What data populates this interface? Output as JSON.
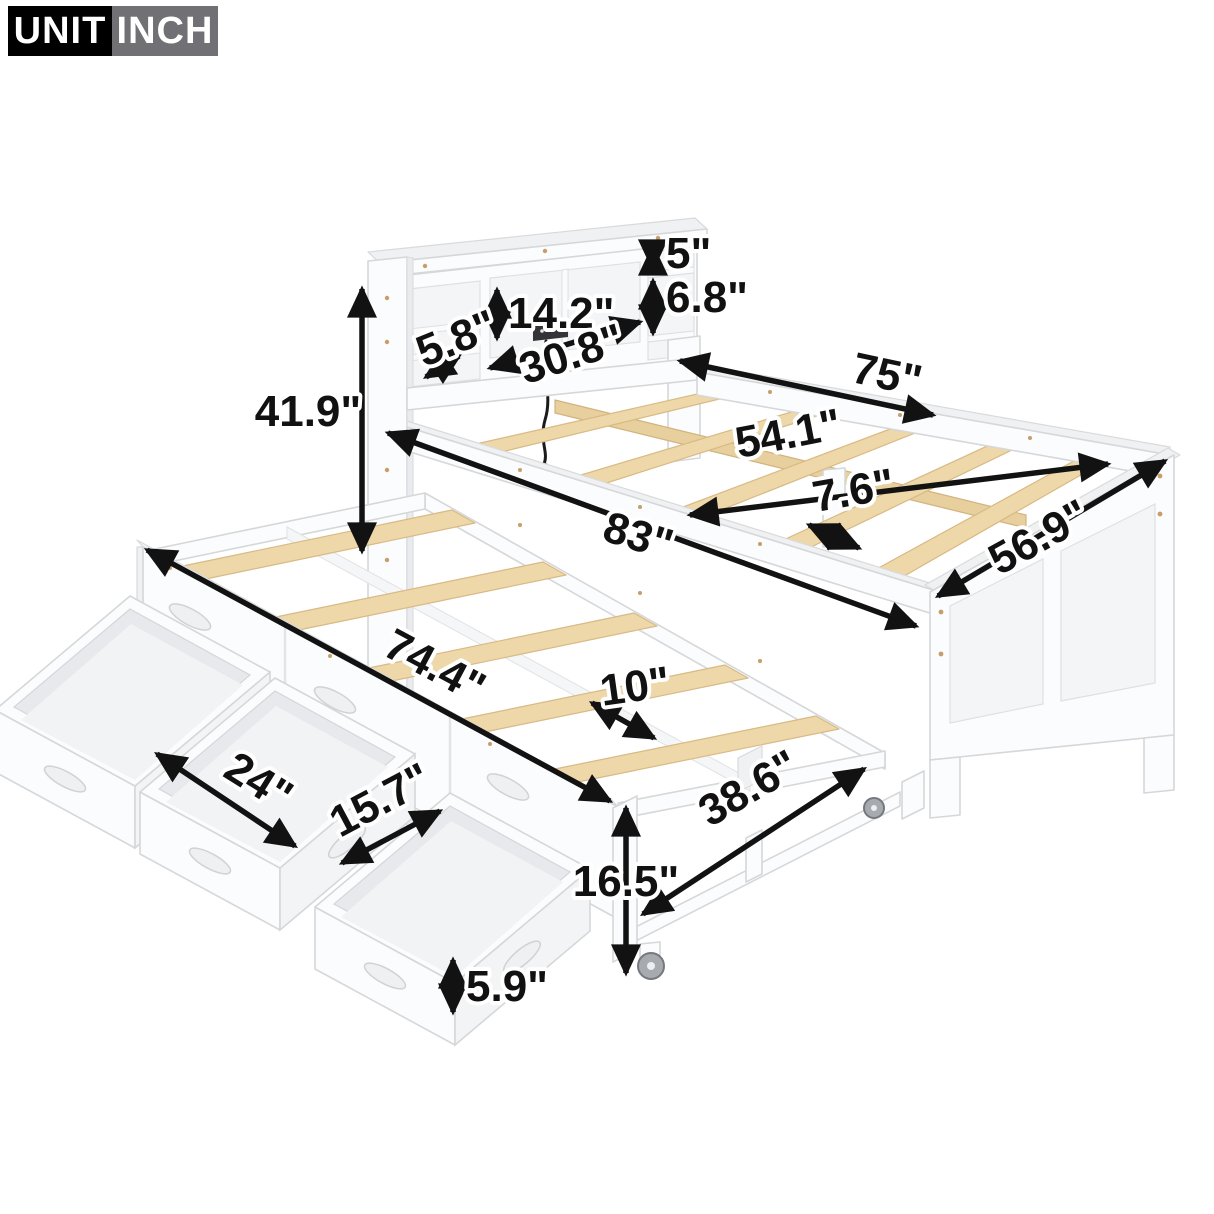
{
  "unit_badge": {
    "unit_label": "UNIT",
    "unit_value": "INCH"
  },
  "colors": {
    "badge_unit_bg": "#000000",
    "badge_inch_bg": "#717175",
    "badge_text": "#ffffff",
    "arrow": "#121212",
    "slat_wood": "#eed7a8",
    "frame_white": "#fbfcfd"
  },
  "dims": {
    "shelf_top": "5\"",
    "shelf_mid": "6.8\"",
    "opening_height": "14.2\"",
    "shelf_depth": "5.8\"",
    "opening_width": "30.8\"",
    "headboard_height": "41.9\"",
    "bed_length": "75\"",
    "bed_inner_width": "54.1\"",
    "slat_gap": "7.6\"",
    "overall_length": "83\"",
    "footboard_width": "56.9\"",
    "trundle_length": "74.4\"",
    "trundle_slat_gap": "10\"",
    "drawer_front_width": "24\"",
    "drawer_opening_width": "15.7\"",
    "trundle_height": "16.5\"",
    "trundle_inner_width": "38.6\"",
    "drawer_height": "5.9\""
  }
}
